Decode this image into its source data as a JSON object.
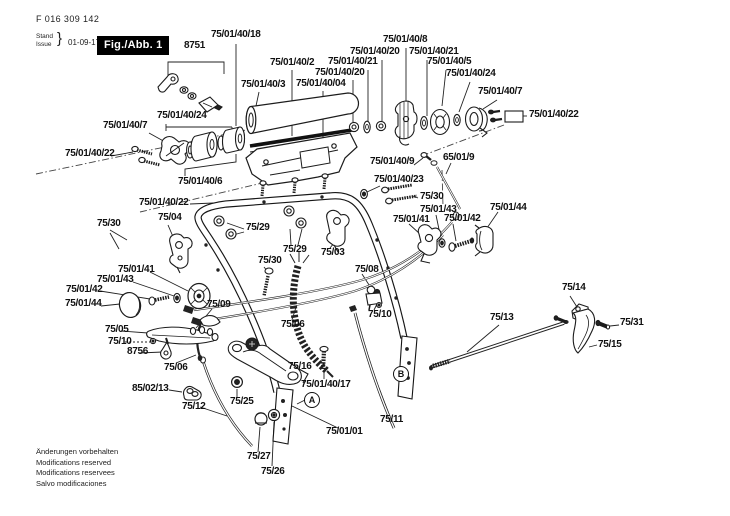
{
  "header": {
    "doc_number": "F 016 309 142",
    "stand_label": "Stand",
    "issue_label": "Issue",
    "brace": "}",
    "date": "01-09-17",
    "fig_label": "Fig./Abb. 1"
  },
  "footer": {
    "lines": [
      "Änderungen vorbehalten",
      "Modifications reserved",
      "Modifications reservees",
      "Salvo modificaciones"
    ]
  },
  "diagram": {
    "colors": {
      "ink": "#1a1a1a",
      "paper": "#ffffff"
    },
    "labels": [
      {
        "text": "8751",
        "x": 184,
        "y": 41
      },
      {
        "text": "75/01/40/18",
        "x": 211,
        "y": 30
      },
      {
        "text": "75/01/40/2",
        "x": 270,
        "y": 58
      },
      {
        "text": "75/01/40/3",
        "x": 241,
        "y": 80
      },
      {
        "text": "75/01/40/04",
        "x": 296,
        "y": 79
      },
      {
        "text": "75/01/40/20",
        "x": 315,
        "y": 68
      },
      {
        "text": "75/01/40/21",
        "x": 328,
        "y": 57
      },
      {
        "text": "75/01/40/20",
        "x": 350,
        "y": 47
      },
      {
        "text": "75/01/40/8",
        "x": 383,
        "y": 35
      },
      {
        "text": "75/01/40/21",
        "x": 409,
        "y": 47
      },
      {
        "text": "75/01/40/5",
        "x": 427,
        "y": 57
      },
      {
        "text": "75/01/40/24",
        "x": 446,
        "y": 69
      },
      {
        "text": "75/01/40/7",
        "x": 478,
        "y": 87
      },
      {
        "text": "75/01/40/22",
        "x": 529,
        "y": 110
      },
      {
        "text": "75/01/40/7",
        "x": 103,
        "y": 121
      },
      {
        "text": "75/01/40/24",
        "x": 157,
        "y": 111
      },
      {
        "text": "75/01/40/22",
        "x": 65,
        "y": 149
      },
      {
        "text": "75/01/40/6",
        "x": 178,
        "y": 177
      },
      {
        "text": "75/01/40/22",
        "x": 139,
        "y": 198
      },
      {
        "text": "75/30",
        "x": 97,
        "y": 219
      },
      {
        "text": "75/04",
        "x": 158,
        "y": 213
      },
      {
        "text": "75/29",
        "x": 246,
        "y": 223
      },
      {
        "text": "75/29",
        "x": 283,
        "y": 245
      },
      {
        "text": "75/03",
        "x": 321,
        "y": 248
      },
      {
        "text": "75/30",
        "x": 258,
        "y": 256
      },
      {
        "text": "75/01/41",
        "x": 118,
        "y": 265
      },
      {
        "text": "75/01/43",
        "x": 97,
        "y": 275
      },
      {
        "text": "75/01/42",
        "x": 66,
        "y": 285
      },
      {
        "text": "75/01/44",
        "x": 65,
        "y": 299
      },
      {
        "text": "75/01/40/9",
        "x": 370,
        "y": 157
      },
      {
        "text": "65/01/9",
        "x": 443,
        "y": 153
      },
      {
        "text": "75/01/40/23",
        "x": 374,
        "y": 175
      },
      {
        "text": "75/30",
        "x": 420,
        "y": 192
      },
      {
        "text": "75/01/43",
        "x": 420,
        "y": 205
      },
      {
        "text": "75/01/44",
        "x": 490,
        "y": 203
      },
      {
        "text": "75/01/41",
        "x": 393,
        "y": 215
      },
      {
        "text": "75/01/42",
        "x": 444,
        "y": 214
      },
      {
        "text": "75/08",
        "x": 355,
        "y": 265
      },
      {
        "text": "75/10",
        "x": 368,
        "y": 310
      },
      {
        "text": "75/06",
        "x": 281,
        "y": 320
      },
      {
        "text": "75/05",
        "x": 105,
        "y": 325
      },
      {
        "text": "75/10",
        "x": 108,
        "y": 337
      },
      {
        "text": "8756",
        "x": 127,
        "y": 347
      },
      {
        "text": "75/06",
        "x": 164,
        "y": 363
      },
      {
        "text": "85/02/13",
        "x": 132,
        "y": 384
      },
      {
        "text": "75/12",
        "x": 182,
        "y": 402
      },
      {
        "text": "75/25",
        "x": 230,
        "y": 397
      },
      {
        "text": "75/16",
        "x": 288,
        "y": 362
      },
      {
        "text": "75/09",
        "x": 207,
        "y": 300
      },
      {
        "text": "75/01/40/17",
        "x": 301,
        "y": 380
      },
      {
        "text": "75/01/01",
        "x": 326,
        "y": 427
      },
      {
        "text": "75/27",
        "x": 247,
        "y": 452
      },
      {
        "text": "75/26",
        "x": 261,
        "y": 467
      },
      {
        "text": "75/11",
        "x": 380,
        "y": 415
      },
      {
        "text": "75/13",
        "x": 490,
        "y": 313
      },
      {
        "text": "75/14",
        "x": 562,
        "y": 283
      },
      {
        "text": "75/31",
        "x": 620,
        "y": 318
      },
      {
        "text": "75/15",
        "x": 598,
        "y": 340
      }
    ],
    "markers": [
      {
        "letter": "A",
        "x": 312,
        "y": 400
      },
      {
        "letter": "B",
        "x": 401,
        "y": 374
      }
    ]
  }
}
